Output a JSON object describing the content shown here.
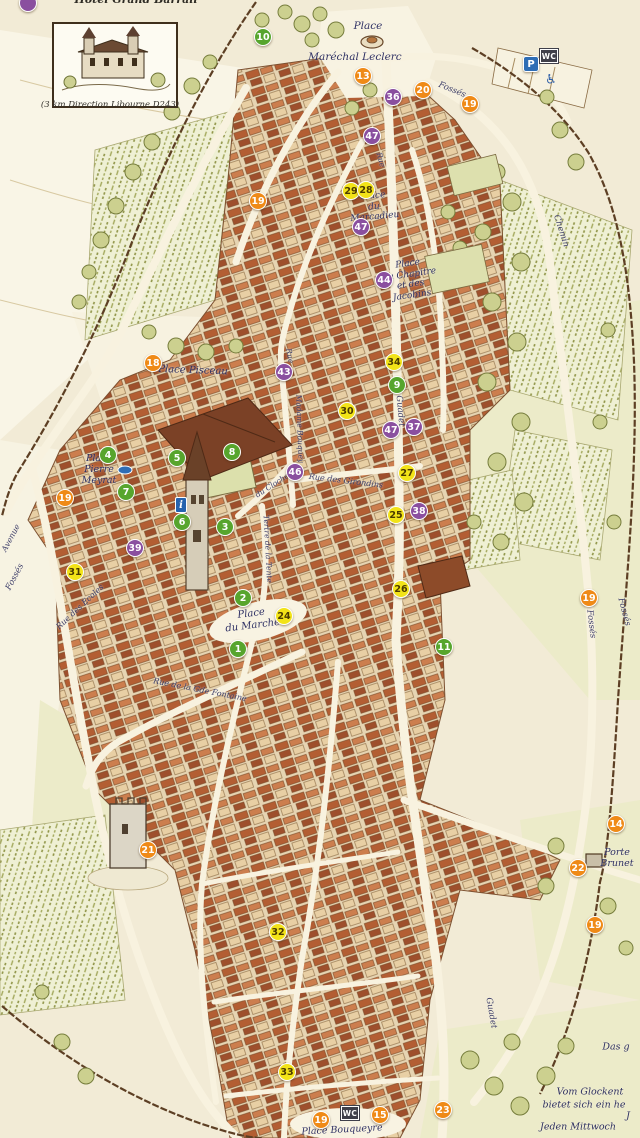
{
  "map": {
    "title_partial": "Hôtel Grand Barrail",
    "inset": {
      "caption": "(3 km Direction Libourne D243)"
    },
    "marker_colors": {
      "orange": "#ef8a17",
      "green": "#57a52d",
      "purple": "#8a4f9f",
      "yellow": "#f2e318",
      "blue": "#2e6db5"
    },
    "markers": [
      {
        "n": "",
        "color": "purple",
        "x": 28,
        "y": 3
      },
      {
        "n": "10",
        "color": "green",
        "x": 263,
        "y": 37
      },
      {
        "n": "13",
        "color": "orange",
        "x": 363,
        "y": 76
      },
      {
        "n": "36",
        "color": "purple",
        "x": 393,
        "y": 97
      },
      {
        "n": "20",
        "color": "orange",
        "x": 423,
        "y": 90
      },
      {
        "n": "19",
        "color": "orange",
        "x": 470,
        "y": 104
      },
      {
        "n": "47",
        "color": "purple",
        "x": 372,
        "y": 136
      },
      {
        "n": "19",
        "color": "orange",
        "x": 258,
        "y": 201
      },
      {
        "n": "29",
        "color": "yellow",
        "x": 351,
        "y": 191
      },
      {
        "n": "28",
        "color": "yellow",
        "x": 366,
        "y": 190
      },
      {
        "n": "47",
        "color": "purple",
        "x": 361,
        "y": 227
      },
      {
        "n": "44",
        "color": "purple",
        "x": 384,
        "y": 280
      },
      {
        "n": "34",
        "color": "yellow",
        "x": 394,
        "y": 362
      },
      {
        "n": "43",
        "color": "purple",
        "x": 284,
        "y": 372
      },
      {
        "n": "9",
        "color": "green",
        "x": 397,
        "y": 385
      },
      {
        "n": "30",
        "color": "yellow",
        "x": 347,
        "y": 411
      },
      {
        "n": "18",
        "color": "orange",
        "x": 153,
        "y": 363
      },
      {
        "n": "47",
        "color": "purple",
        "x": 391,
        "y": 430
      },
      {
        "n": "37",
        "color": "purple",
        "x": 414,
        "y": 427
      },
      {
        "n": "4",
        "color": "green",
        "x": 108,
        "y": 455
      },
      {
        "n": "5",
        "color": "green",
        "x": 177,
        "y": 458
      },
      {
        "n": "8",
        "color": "green",
        "x": 232,
        "y": 452
      },
      {
        "n": "7",
        "color": "green",
        "x": 126,
        "y": 492
      },
      {
        "n": "19",
        "color": "orange",
        "x": 65,
        "y": 498
      },
      {
        "n": "46",
        "color": "purple",
        "x": 295,
        "y": 472
      },
      {
        "n": "27",
        "color": "yellow",
        "x": 407,
        "y": 473
      },
      {
        "n": "6",
        "color": "green",
        "x": 182,
        "y": 522
      },
      {
        "n": "3",
        "color": "green",
        "x": 225,
        "y": 527
      },
      {
        "n": "38",
        "color": "purple",
        "x": 419,
        "y": 511
      },
      {
        "n": "25",
        "color": "yellow",
        "x": 396,
        "y": 515
      },
      {
        "n": "39",
        "color": "purple",
        "x": 135,
        "y": 548
      },
      {
        "n": "31",
        "color": "yellow",
        "x": 75,
        "y": 572
      },
      {
        "n": "26",
        "color": "yellow",
        "x": 401,
        "y": 589
      },
      {
        "n": "19",
        "color": "orange",
        "x": 589,
        "y": 598
      },
      {
        "n": "2",
        "color": "green",
        "x": 243,
        "y": 598
      },
      {
        "n": "24",
        "color": "yellow",
        "x": 284,
        "y": 616
      },
      {
        "n": "1",
        "color": "green",
        "x": 238,
        "y": 649
      },
      {
        "n": "11",
        "color": "green",
        "x": 444,
        "y": 647
      },
      {
        "n": "14",
        "color": "orange",
        "x": 616,
        "y": 824
      },
      {
        "n": "21",
        "color": "orange",
        "x": 148,
        "y": 850
      },
      {
        "n": "22",
        "color": "orange",
        "x": 578,
        "y": 868
      },
      {
        "n": "19",
        "color": "orange",
        "x": 595,
        "y": 925
      },
      {
        "n": "32",
        "color": "yellow",
        "x": 278,
        "y": 932
      },
      {
        "n": "33",
        "color": "yellow",
        "x": 287,
        "y": 1072
      },
      {
        "n": "19",
        "color": "orange",
        "x": 321,
        "y": 1120
      },
      {
        "n": "15",
        "color": "orange",
        "x": 380,
        "y": 1115
      },
      {
        "n": "23",
        "color": "orange",
        "x": 443,
        "y": 1110
      }
    ],
    "badges": [
      {
        "type": "parking",
        "label": "P",
        "x": 531,
        "y": 64
      },
      {
        "type": "wc",
        "label": "WC",
        "x": 549,
        "y": 56
      },
      {
        "type": "accessible",
        "label": "♿",
        "x": 551,
        "y": 80
      },
      {
        "type": "info",
        "label": "i",
        "x": 181,
        "y": 505
      },
      {
        "type": "wc",
        "label": "WC",
        "x": 350,
        "y": 1113
      }
    ],
    "places": [
      {
        "id": "place-leclerc-1",
        "text": "Place",
        "x": 368,
        "y": 26,
        "rot": 0,
        "fs": 10.5
      },
      {
        "id": "place-leclerc-2",
        "text": "Maréchal Leclerc",
        "x": 355,
        "y": 57,
        "rot": 0,
        "fs": 10.5
      },
      {
        "id": "place-marcadieu",
        "text": "Place\ndu\nMarcadieu",
        "x": 374,
        "y": 207,
        "rot": -5,
        "fs": 9
      },
      {
        "id": "place-chapitre",
        "text": "Place\ndu Chapitre\net des\nJacobins",
        "x": 410,
        "y": 280,
        "rot": -8,
        "fs": 9
      },
      {
        "id": "place-pisceau",
        "text": "Place Pisceau",
        "x": 193,
        "y": 371,
        "rot": 2,
        "fs": 10
      },
      {
        "id": "place-meyrat",
        "text": "Place\nPierre\nMeyrat",
        "x": 99,
        "y": 470,
        "rot": 0,
        "fs": 9.5
      },
      {
        "id": "place-marche",
        "text": "Place\ndu Marché",
        "x": 252,
        "y": 620,
        "rot": -7,
        "fs": 10
      },
      {
        "id": "place-bouqueyre",
        "text": "Place Bouqueyre",
        "x": 342,
        "y": 1130,
        "rot": -3,
        "fs": 9.5
      },
      {
        "id": "porte-brunet",
        "text": "Porte\nBrunet",
        "x": 617,
        "y": 858,
        "rot": 0,
        "fs": 9.5
      }
    ],
    "streets": [
      {
        "id": "fosses-top",
        "text": "Fossés",
        "x": 452,
        "y": 90,
        "rot": 22,
        "fs": 8.5
      },
      {
        "id": "fosses-left",
        "text": "Fossés",
        "x": 15,
        "y": 577,
        "rot": -62,
        "fs": 8.5
      },
      {
        "id": "avenue-left",
        "text": "Avenue",
        "x": 11,
        "y": 538,
        "rot": -62,
        "fs": 8
      },
      {
        "id": "fosses-right-1",
        "text": "Fossés",
        "x": 591,
        "y": 624,
        "rot": 83,
        "fs": 8.5
      },
      {
        "id": "fosses-right-2",
        "text": "Fossés",
        "x": 624,
        "y": 612,
        "rot": 75,
        "fs": 8.5
      },
      {
        "id": "chemin",
        "text": "Chemin",
        "x": 561,
        "y": 231,
        "rot": 72,
        "fs": 8.5
      },
      {
        "id": "guadet",
        "text": "Guadet",
        "x": 400,
        "y": 411,
        "rot": 85,
        "fs": 8.5
      },
      {
        "id": "rue-des-girondins",
        "text": "Rue des Girondins",
        "x": 346,
        "y": 481,
        "rot": 7,
        "fs": 8
      },
      {
        "id": "madame-bouquey",
        "text": "Madame Bouquey",
        "x": 299,
        "y": 429,
        "rot": 88,
        "fs": 7.5
      },
      {
        "id": "rue-1",
        "text": "Rue",
        "x": 289,
        "y": 356,
        "rot": 80,
        "fs": 7.5
      },
      {
        "id": "rue-2",
        "text": "Rue",
        "x": 380,
        "y": 160,
        "rot": 75,
        "fs": 7.5
      },
      {
        "id": "rue-gde-fontaine",
        "text": "Rue de la Gde Fontaine",
        "x": 200,
        "y": 690,
        "rot": 11,
        "fs": 8
      },
      {
        "id": "rue-des-ecoles",
        "text": "Rue des Ecoles",
        "x": 80,
        "y": 607,
        "rot": -43,
        "fs": 8
      },
      {
        "id": "du-clocher",
        "text": "du Clocher",
        "x": 274,
        "y": 485,
        "rot": -33,
        "fs": 7.5
      },
      {
        "id": "tertre-de-la-tente",
        "text": "Tertre de la Tente",
        "x": 267,
        "y": 549,
        "rot": 87,
        "fs": 7.5
      },
      {
        "id": "guadet-south",
        "text": "Guadet",
        "x": 491,
        "y": 1013,
        "rot": 80,
        "fs": 8.5
      }
    ],
    "notes": [
      {
        "id": "note-1",
        "text": "Das g",
        "x": 616,
        "y": 1047,
        "fs": 9.5
      },
      {
        "id": "note-2",
        "text": "Vom Glockent",
        "x": 590,
        "y": 1092,
        "fs": 9.5
      },
      {
        "id": "note-3",
        "text": "bietet sich ein he",
        "x": 584,
        "y": 1105,
        "fs": 9.5
      },
      {
        "id": "note-4",
        "text": "J",
        "x": 628,
        "y": 1116,
        "fs": 9.5
      },
      {
        "id": "note-5",
        "text": "Jeden Mittwoch",
        "x": 578,
        "y": 1127,
        "fs": 9.5
      }
    ]
  }
}
